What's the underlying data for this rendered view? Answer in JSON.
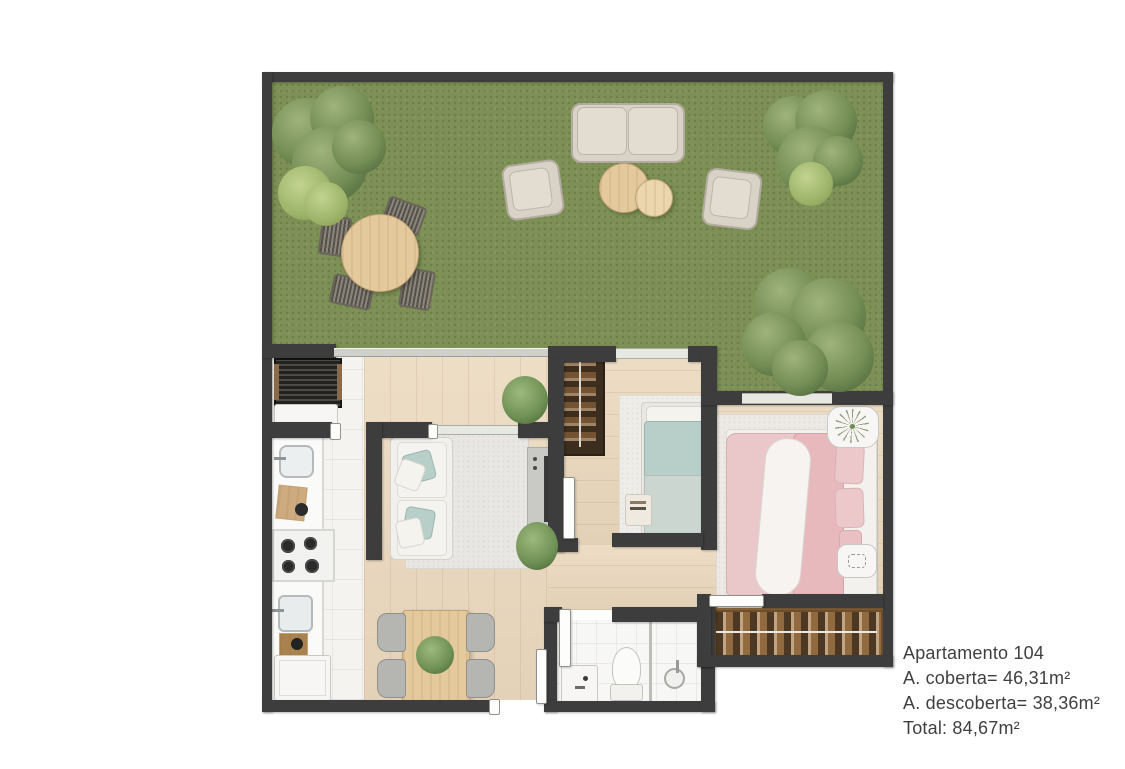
{
  "plan_label": {
    "title": "Apartamento 104",
    "covered_area": "A. coberta= 46,31m²",
    "uncovered_area": "A. descoberta= 38,36m²",
    "total_area": "Total: 84,67m²"
  },
  "palette": {
    "wall": "#3d3d3d",
    "grass": "#7d9055",
    "wood_floor": "#ebd9be",
    "tile_floor": "#f4f3f0",
    "table_wood": "#e4c99c",
    "bed_single_blue": "#b7cfc8",
    "bed_double_pink": "#eac7c9",
    "outdoor_furniture": "#d9d3c7",
    "foliage": "#6f8a52",
    "closet_wood": "#a07648",
    "text": "#3f3f3f",
    "background": "#ffffff"
  }
}
